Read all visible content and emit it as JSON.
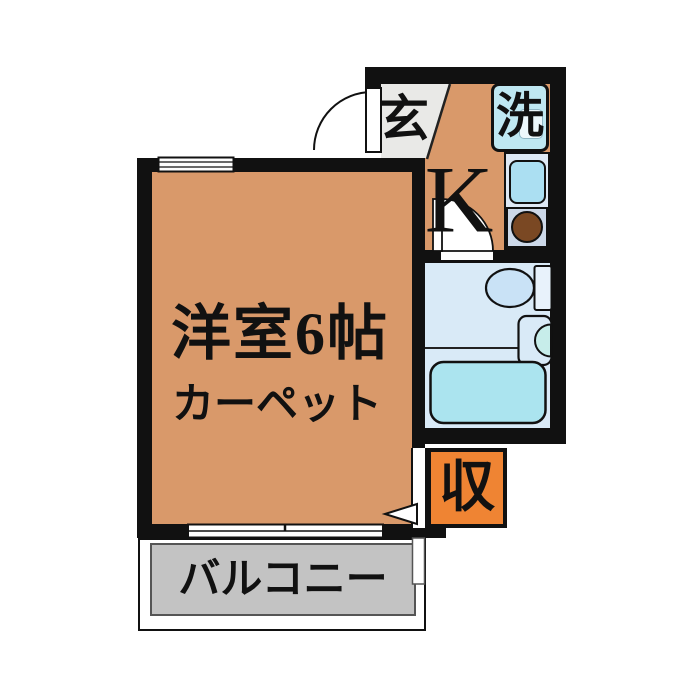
{
  "plan": {
    "type": "floorplan",
    "labels": {
      "main_room": "洋室6帖",
      "main_room_floor": "カーペット",
      "kitchen": "K",
      "entrance": "玄",
      "laundry": "洗",
      "storage": "収",
      "balcony": "バルコニー"
    },
    "colors": {
      "room_floor": "#D9996A",
      "storage_box": "#EF8433",
      "bath_floor": "#D9EAF7",
      "bathtub": "#ABE4EF",
      "laundry_box": "#BFE8F2",
      "counter": "#DEE9F5",
      "sink": "#ABDFF2",
      "burner": "#7A4823",
      "balcony_floor": "#C3C3C3",
      "entrance_floor": "#E9E9E7",
      "wall": "#111111"
    }
  }
}
